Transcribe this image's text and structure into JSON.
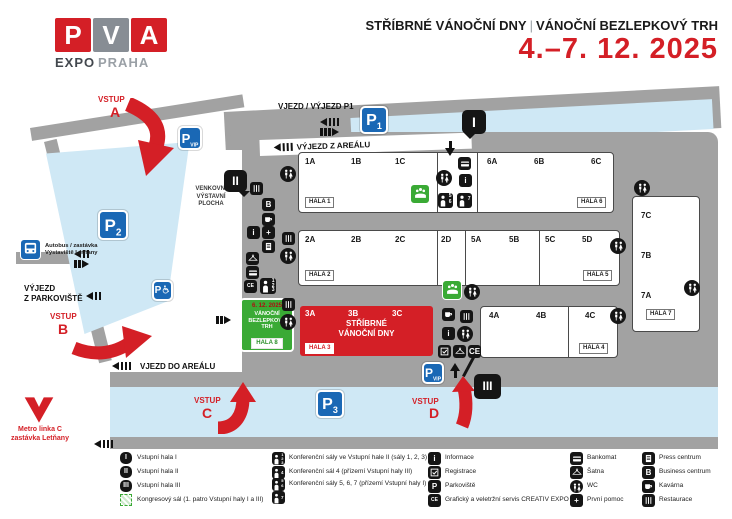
{
  "header": {
    "logo": {
      "p": "P",
      "v": "V",
      "a": "A",
      "expo": "EXPO",
      "praha": "PRAHA"
    },
    "title": {
      "left": "STŘÍBRNÉ VÁNOČNÍ DNY",
      "sep": "|",
      "right": "VÁNOČNÍ BEZLEPKOVÝ TRH",
      "date": "4.–7. 12. 2025"
    }
  },
  "map": {
    "vstup": "VSTUP",
    "entrances": {
      "a": "A",
      "b": "B",
      "c": "C",
      "d": "D"
    },
    "roads": {
      "p1": "VJEZD / VÝJEZD P1",
      "exit_area": "VÝJEZD Z AREÁLU",
      "enter_area": "VJEZD DO AREÁLU",
      "exit_parking1": "VÝJEZD",
      "exit_parking2": "Z PARKOVIŠTĚ"
    },
    "parking": {
      "letter": "P",
      "p1": "1",
      "p2": "2",
      "p3": "3",
      "vip": "VIP"
    },
    "transit": {
      "bus1": "Autobus / zastávka",
      "bus2": "Výstaviště Letňany",
      "metro1": "Metro linka C",
      "metro2": "zastávka Letňany"
    },
    "outdoor": {
      "l1": "VENKOVNÍ",
      "l2": "VÝSTAVNÍ",
      "l3": "PLOCHA"
    },
    "halls": {
      "hala1": {
        "s": [
          "1A",
          "1B",
          "1C"
        ],
        "label": "HALA 1"
      },
      "hala6": {
        "s": [
          "6A",
          "6B",
          "6C"
        ],
        "label": "HALA 6"
      },
      "hala2": {
        "s": [
          "2A",
          "2B",
          "2C"
        ],
        "label": "HALA 2"
      },
      "d2": "2D",
      "hala5": {
        "s": [
          "5A",
          "5B",
          "5C",
          "5D"
        ],
        "label": "HALA 5"
      },
      "hala3": {
        "s": [
          "3A",
          "3B",
          "3C"
        ],
        "label": "HALA 3",
        "e1": "STŘÍBRNÉ",
        "e2": "VÁNOČNÍ DNY"
      },
      "hala4": {
        "s": [
          "4A",
          "4B",
          "4C"
        ],
        "label": "HALA 4"
      },
      "hala7": {
        "s": [
          "7C",
          "7B",
          "7A"
        ],
        "label": "HALA 7"
      },
      "hala8": {
        "date": "6. 12. 2025",
        "event": "VÁNOČNÍ BEZLEPKOVÝ TRH",
        "label": "HALA 8"
      }
    },
    "markers": {
      "i": "I",
      "ii": "II",
      "iii": "III"
    },
    "conf_nums": {
      "n1": "1",
      "n2": "2",
      "n3": "3",
      "n4": "4",
      "n5": "5",
      "n6": "6",
      "n7": "7"
    },
    "glyphs": {
      "info": "i",
      "business": "B",
      "plus": "+",
      "ce": "CE"
    },
    "colors": {
      "brand_red": "#d41f26",
      "parking_blue": "#1a68b5",
      "area_blue": "#cfe8f5",
      "road_gray": "#a2a2a2",
      "event_green": "#3aaa35"
    }
  },
  "legend": {
    "items": {
      "hala_i": "Vstupní hala I",
      "hala_ii": "Vstupní hala II",
      "hala_iii": "Vstupní hala III",
      "kongres": "Kongresový sál (1. patro Vstupní haly I a III)",
      "konf_123": "Konferenční sály ve Vstupní hale II (sály 1, 2, 3)",
      "konf_4": "Konferenční sál 4 (přízemí Vstupní haly III)",
      "konf_567": "Konferenční sály 5, 6, 7 (přízemí Vstupní haly I)",
      "informace": "Informace",
      "registrace": "Registrace",
      "parkoviste": "Parkoviště",
      "creativ": "Grafický a veletržní servis CREATIV EXPO",
      "bankomat": "Bankomat",
      "satna": "Šatna",
      "wc": "WC",
      "prvni_pomoc": "První pomoc",
      "press": "Press centrum",
      "business": "Business centrum",
      "kavarna": "Kavárna",
      "restaurace": "Restaurace"
    }
  }
}
